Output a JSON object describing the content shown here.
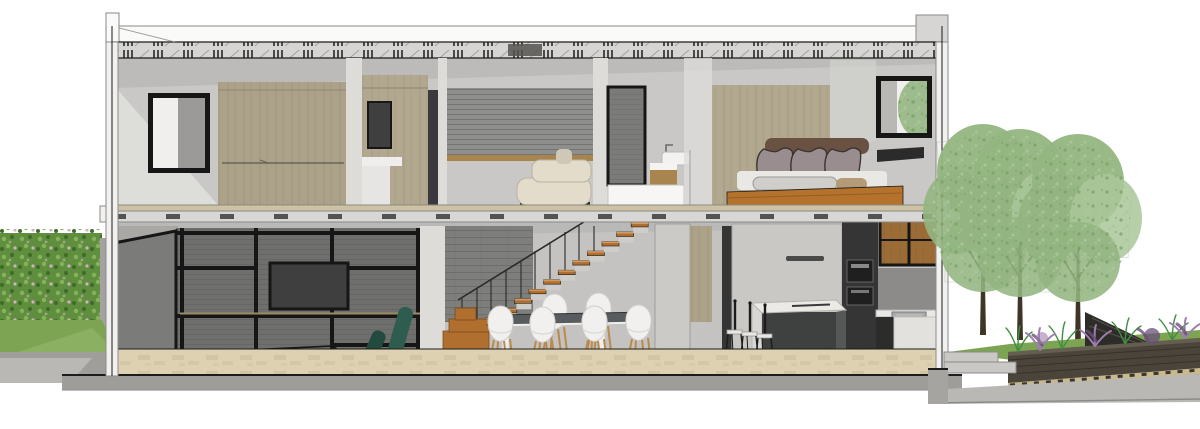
{
  "meta": {
    "title": "Architectural cross-section rendering of a two-storey house",
    "canvas": {
      "width": 1200,
      "height": 429
    },
    "style": "SketchUp-like section perspective, white background, no visible text"
  },
  "palette": {
    "bg": "#ffffff",
    "line_dark": "#1c1c1c",
    "line_mid": "#8a8a88",
    "cut_white": "#f2f1ef",
    "pier_light": "#dddcd9",
    "wall_upper": "#c9c8c6",
    "wall_lower": "#c4c3c1",
    "ceiling_shade": "#b2b1af",
    "roof_band": "#d6d5d3",
    "fascia": "#fafaf9",
    "tick_dark": "#4a4a48",
    "wood_wardrobe": "#aca28a",
    "wood_bedwall": "#b2a88f",
    "wood_shelf_strip": "#a8854f",
    "wood_floor": "#cfc2a2",
    "travertine": "#ddd1b2",
    "travertine_dark": "#c6b998",
    "feature_wall": "#8e8e8c",
    "living_wall": "#6f6f6d",
    "stria_dark": "#5f5f5d",
    "frame_black": "#161616",
    "tv_screen": "#3f3f3f",
    "sofa_cream": "#e3dccb",
    "sofa_cream_dark": "#cfc8b6",
    "door_gray": "#7b7b79",
    "pillow_mauve": "#9a8d90",
    "pillow_brown": "#6a5243",
    "duvet_light": "#eae8e4",
    "duvet_gray": "#cfcecb",
    "blanket_tan": "#b49a76",
    "bed_wood": "#b5722c",
    "stair_wood": "#b06f2e",
    "stair_tread_top": "#d29a5e",
    "riser_light": "#cfcdc9",
    "chair_green": "#2e5c4e",
    "chair_green_dark": "#234a3e",
    "chair_white": "#f1f0ee",
    "chair_leg_wood": "#b98a4e",
    "table_top": "#585c5e",
    "island_top": "#eceae6",
    "island_dark": "#3f4040",
    "island_side": "#565757",
    "fridge_gray": "#c9c8c5",
    "kitchen_dark": "#353535",
    "appliance_black": "#1f1f1f",
    "cabinet_wood": "#9b6c35",
    "niche_gray": "#8c8b89",
    "sink_steel": "#a9abac",
    "counter_white": "#e9e8e5",
    "glass_light": "#f0efed",
    "glass_dark": "#9b9a98",
    "hedge_green": "#5f8f3e",
    "hedge_light": "#86b25a",
    "hedge_dark": "#3e6b28",
    "flower_pink": "#d3aec0",
    "grass": "#7da453",
    "grass_light": "#95b96a",
    "pavement": "#b9b8b5",
    "pavement_dark": "#9f9e9b",
    "slab_gray": "#9e9d9a",
    "tree_green": "#93b581",
    "tree_green_light": "#aac79a",
    "tree_green_dark": "#74a061",
    "trunk_brown": "#3f3428",
    "planter_wall": "#4a443a",
    "lavender": "#9d7fae",
    "lavender_dark": "#6b4f7a",
    "plant_green": "#3f8f3f",
    "step_gray": "#c9c8c5",
    "brick_edge": "#c8b98e",
    "shadow": "#6f6e6b"
  },
  "scene": {
    "outdoor_left": {
      "items": [
        "flowering-hedge",
        "lawn",
        "pavement"
      ]
    },
    "building": {
      "roof": {
        "items": [
          "parapet-cap",
          "joist-band",
          "left-post",
          "right-parapet-block"
        ]
      },
      "upper_floor": {
        "rooms": [
          {
            "name": "dressing-room",
            "items": [
              "window-black-frame",
              "wood-wardrobe",
              "hanging-rail"
            ]
          },
          {
            "name": "tv-lounge",
            "items": [
              "wood-media-wall",
              "wall-tv",
              "gray-feature-wall",
              "cream-sofa"
            ]
          },
          {
            "name": "bathroom-landing",
            "items": [
              "dark-pocket-door",
              "washbasin",
              "wood-stool",
              "white-guard-wall"
            ]
          },
          {
            "name": "bedroom",
            "items": [
              "wood-headboard-wall",
              "bed-with-pillows",
              "timber-bed-platform",
              "window-with-tree-view",
              "dark-console"
            ]
          }
        ]
      },
      "lower_floor": {
        "rooms": [
          {
            "name": "living-room",
            "items": [
              "pivot-door",
              "dark-shelving-wall",
              "black-steel-shelf-grid",
              "wall-tv",
              "wire-coffee-table",
              "green-lounge-chair"
            ]
          },
          {
            "name": "stair-hall",
            "items": [
              "timber-staircase",
              "block-bottom-steps",
              "balusters",
              "brick-texture-wall"
            ]
          },
          {
            "name": "dining-area",
            "items": [
              "white-frame-table-dark-top",
              "six-white-shell-chairs"
            ]
          },
          {
            "name": "kitchen",
            "items": [
              "wood-corridor-wardrobe",
              "dark-internal-door",
              "gray-tall-cabinet-with-handle",
              "dark-oven-column",
              "wood-upper-cabinets-black-frame",
              "sink-counter",
              "kitchen-island",
              "three-bar-stools"
            ]
          }
        ],
        "floor": "travertine-tiles"
      },
      "structure": [
        "intermediate-slab-with-joist-dashes",
        "timber-floor-strip",
        "ground-slab-band",
        "white-section-cut-walls"
      ]
    },
    "outdoor_right": {
      "items": [
        "three-deciduous-trees",
        "garden-steps",
        "raised-planter-dark-wall",
        "ornamental-grasses",
        "lavender-shrubs",
        "dark-fence-wedge",
        "paver-edge-strip",
        "sloping-pavement"
      ]
    }
  }
}
